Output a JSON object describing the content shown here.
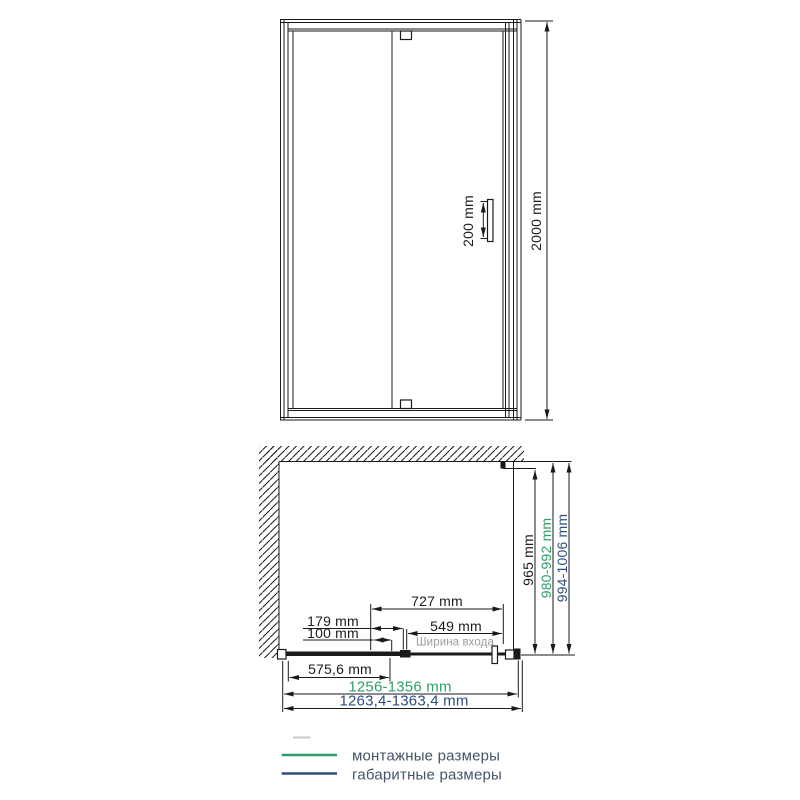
{
  "front_view": {
    "handle_dim": "200 mm",
    "height_dim": "2000 mm"
  },
  "plan_view": {
    "width_727": "727 mm",
    "width_179": "179 mm",
    "width_100": "100 mm",
    "width_549": "549 mm",
    "entrance_label": "Ширина входа",
    "width_575": "575,6 mm",
    "depth_glass": "965 mm",
    "depth_mount": "980-992 mm",
    "depth_overall": "994-1006 mm",
    "width_mount": "1256-1356 mm",
    "width_overall": "1263,4-1363,4 mm"
  },
  "legend": {
    "mounting_label": "монтажные размеры",
    "overall_label": "габаритные размеры"
  },
  "colors": {
    "line": "#1a1a1a",
    "mount_green": "#2f9e6a",
    "overall_blue": "#2e4d7d",
    "muted_gray": "#9d9d9d",
    "legend_text": "#44546a"
  }
}
